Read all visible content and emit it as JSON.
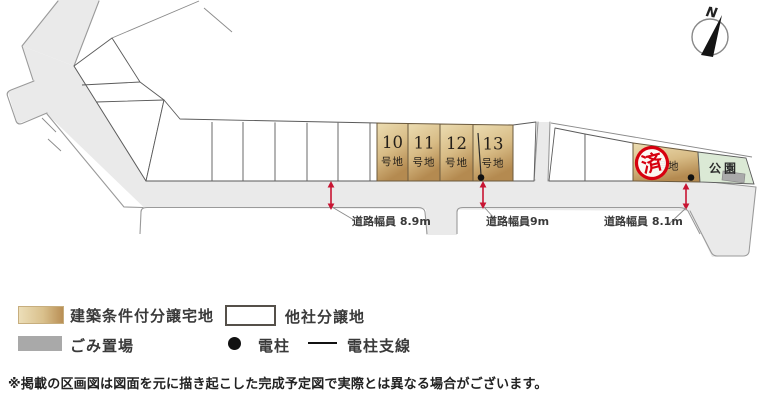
{
  "map": {
    "compass_label": "N",
    "lots": [
      {
        "number": "10",
        "suffix": "号地"
      },
      {
        "number": "11",
        "suffix": "号地"
      },
      {
        "number": "12",
        "suffix": "号地"
      },
      {
        "number": "13",
        "suffix": "号地"
      }
    ],
    "sold_lot": {
      "stamp": "済",
      "suffix": "号地"
    },
    "park_label": "公園",
    "road_width_labels": [
      "道路幅員 8.9m",
      "道路幅員9m",
      "道路幅員 8.1m"
    ]
  },
  "legend": {
    "tan_label": "建築条件付分譲宅地",
    "white_label": "他社分譲地",
    "gray_label": "ごみ置場",
    "pole_label": "電柱",
    "wire_label": "電柱支線"
  },
  "disclaimer": "※掲載の区画図は図面を元に描き起こした完成予定図で実際とは異なる場合がございます。",
  "colors": {
    "lot_tan_light": "#ecdeb8",
    "lot_tan_dark": "#b98f55",
    "road_gray": "#eaeaea",
    "park_green": "#dbe9d5",
    "trash_gray": "#a9a9a9",
    "accent_red": "#c81432",
    "stamp_red": "#d7000f"
  }
}
